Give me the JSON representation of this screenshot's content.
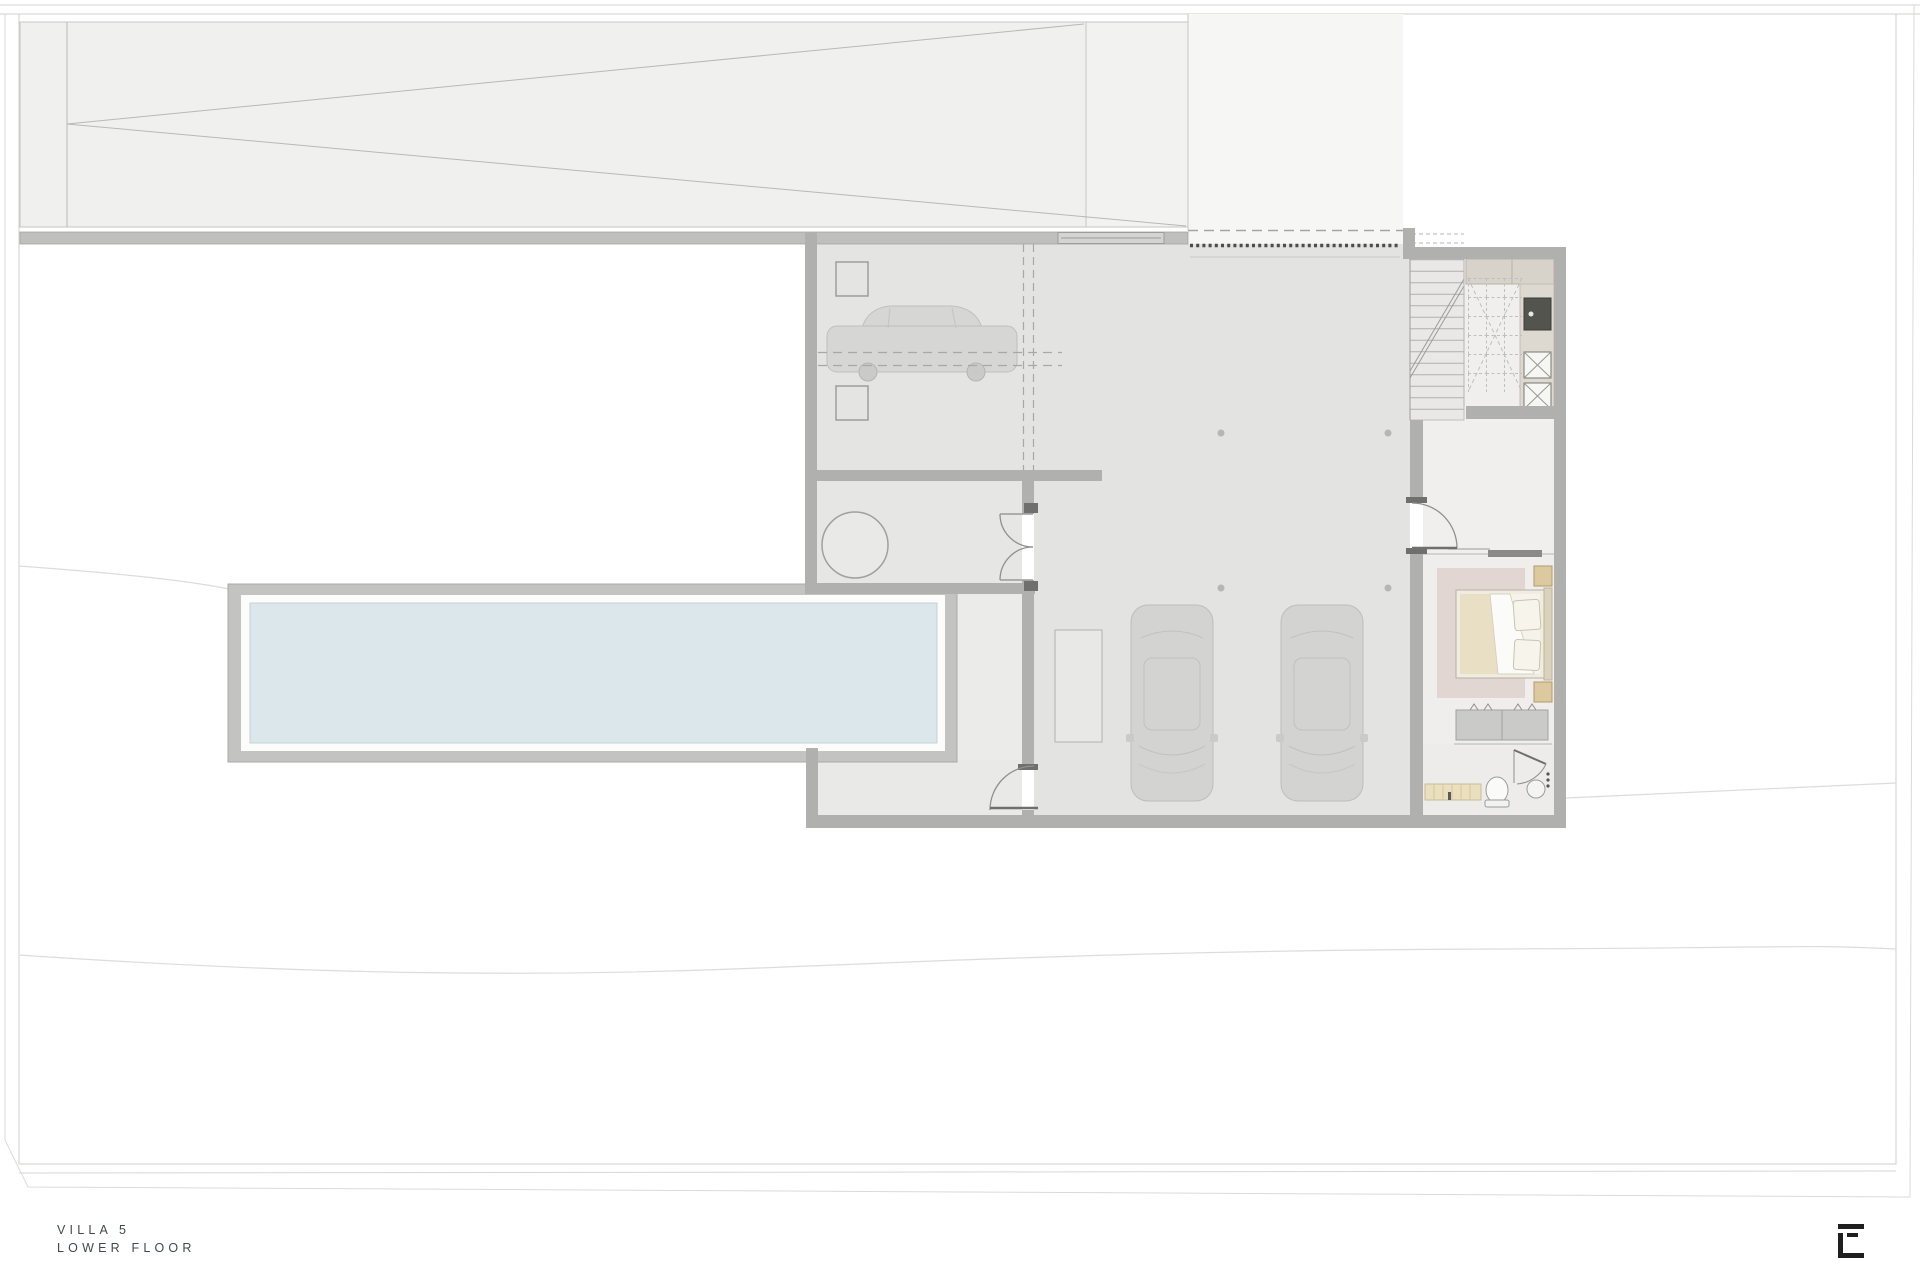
{
  "title": {
    "line1": "VILLA 5",
    "line2": "LOWER FLOOR"
  },
  "logo": {
    "glyph": "E"
  },
  "palette": {
    "paper": "#ffffff",
    "site_line": "#cfcfcd",
    "ramp_fill": "#f0f0ee",
    "courtyard_fill": "#f6f6f4",
    "wall": "#b0b0ae",
    "wall_dark_cap": "#6f6f6d",
    "garage_floor": "#e3e3e1",
    "room_floor": "#efeeec",
    "pool_deck": "#c3c3c1",
    "pool_rim": "#fcfcfb",
    "pool_water": "#dbe7eb",
    "rug": "#e2d6d3",
    "mattress": "#e9dfc4",
    "duvet": "#fbfbf9",
    "nightstand_wood": "#dcc9a0",
    "counter_tan": "#d7d2ca",
    "dark_fixture": "#54544f",
    "bench_cream": "#eadfbe",
    "car_body": "#d1d1cf",
    "garage_door_dash": "#4c4c48",
    "text": "#43484e",
    "logo_ink": "#1f1f1f"
  },
  "features": {
    "ramp": "driveway-ramp",
    "retaining_wall": "retaining-wall",
    "courtyard": "entry-courtyard",
    "garage_door": "garage-door-dashed",
    "single_garage": "garage-single-car",
    "main_garage": "garage-two-cars",
    "lounge": "round-table-room",
    "pool": "lap-pool",
    "terrace": "lower-terrace",
    "stairs": "staircase",
    "laundry": "laundry-utility-room",
    "bedroom": "bedroom",
    "vanity": "double-vanity",
    "bathroom": "bathroom"
  }
}
